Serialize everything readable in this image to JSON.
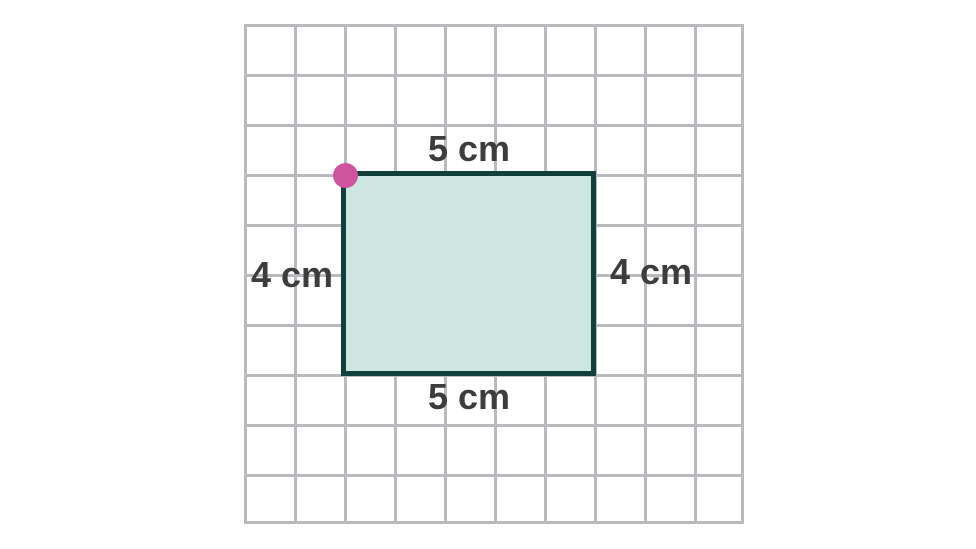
{
  "figure": {
    "shape": "rectangle",
    "width_cm": 5,
    "height_cm": 4,
    "marked_vertex": "top-left",
    "grid": {
      "columns": 10,
      "rows": 10,
      "cell_represents": "1 cm",
      "rect_position": {
        "col_start": 2,
        "row_start": 3,
        "col_span": 5,
        "row_span": 4
      }
    }
  },
  "labels": {
    "top": "5 cm",
    "bottom": "5 cm",
    "left": "4 cm",
    "right": "4 cm"
  },
  "colors": {
    "background": "#ffffff",
    "grid_line": "#b9babd",
    "shape_fill": "#cee6e0",
    "shape_stroke": "#11403c",
    "vertex_dot": "#d0539f",
    "label_text": "#3d3d3d"
  }
}
